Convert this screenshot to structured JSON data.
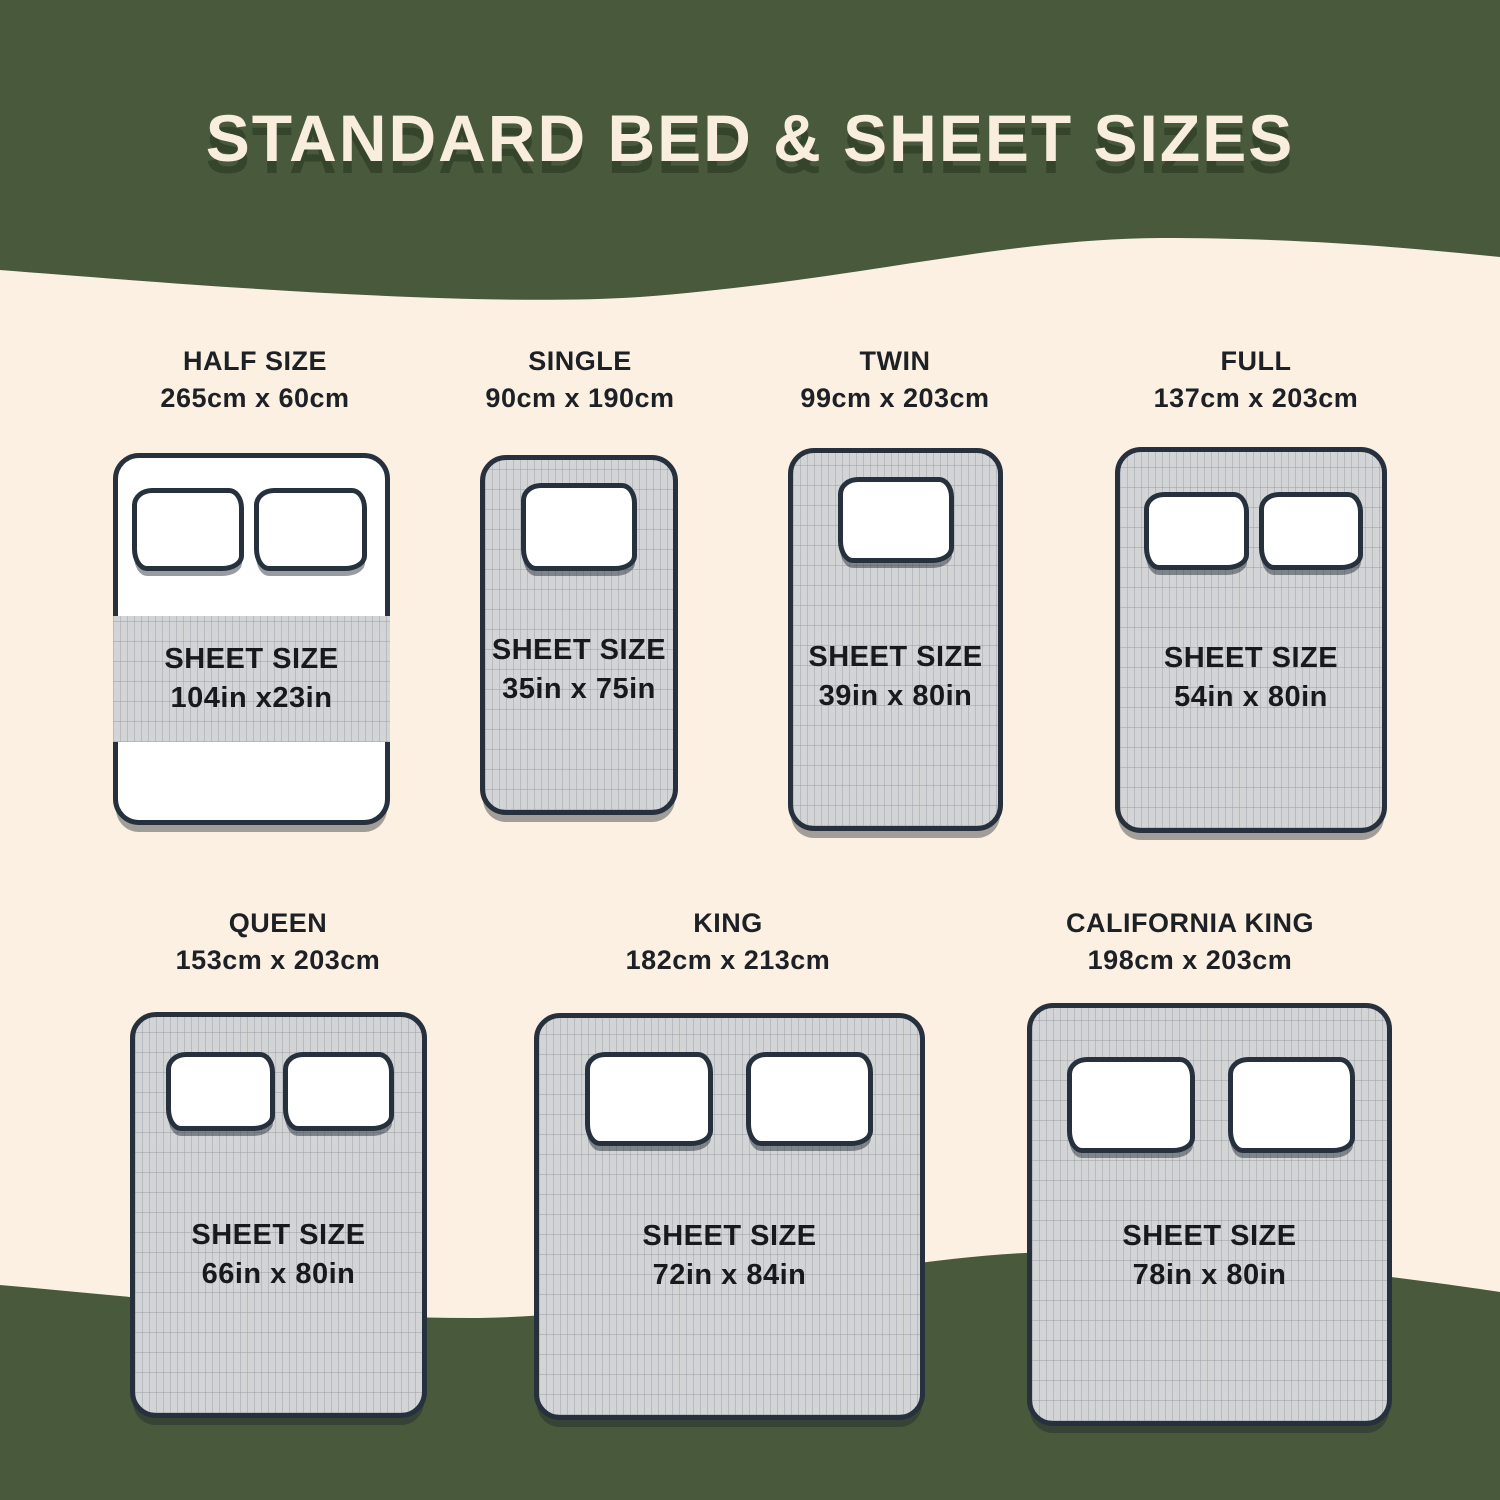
{
  "title": "STANDARD BED & SHEET SIZES",
  "colors": {
    "background_cream": "#fbf0e2",
    "wave_green": "#49593b",
    "title_text": "#f9eedd",
    "title_shadow": "#35452c",
    "bed_outline": "#26313d",
    "sheet_gray": "#d2d4d6",
    "label_text": "#1d2126"
  },
  "beds": [
    {
      "name": "HALF SIZE",
      "dimensions": "265cm x 60cm",
      "sheet_label": "SHEET SIZE",
      "sheet_size": "104in x23in",
      "pillows": 2
    },
    {
      "name": "SINGLE",
      "dimensions": "90cm x 190cm",
      "sheet_label": "SHEET SIZE",
      "sheet_size": "35in x 75in",
      "pillows": 1
    },
    {
      "name": "TWIN",
      "dimensions": "99cm x 203cm",
      "sheet_label": "SHEET SIZE",
      "sheet_size": "39in x 80in",
      "pillows": 1
    },
    {
      "name": "FULL",
      "dimensions": "137cm x 203cm",
      "sheet_label": "SHEET SIZE",
      "sheet_size": "54in x 80in",
      "pillows": 2
    },
    {
      "name": "QUEEN",
      "dimensions": "153cm x 203cm",
      "sheet_label": "SHEET SIZE",
      "sheet_size": "66in x 80in",
      "pillows": 2
    },
    {
      "name": "KING",
      "dimensions": "182cm x 213cm",
      "sheet_label": "SHEET SIZE",
      "sheet_size": "72in x 84in",
      "pillows": 2
    },
    {
      "name": "CALIFORNIA KING",
      "dimensions": "198cm x 203cm",
      "sheet_label": "SHEET SIZE",
      "sheet_size": "78in x 80in",
      "pillows": 2
    }
  ]
}
